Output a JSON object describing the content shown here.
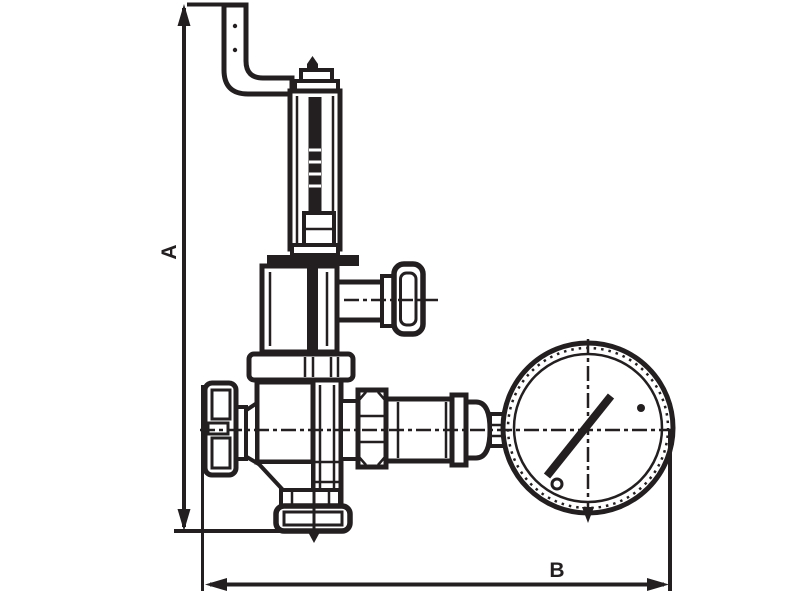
{
  "diagram": {
    "dimension_labels": {
      "vertical": "A",
      "horizontal": "B"
    },
    "colors": {
      "line": "#231f20",
      "background": "#ffffff"
    }
  }
}
